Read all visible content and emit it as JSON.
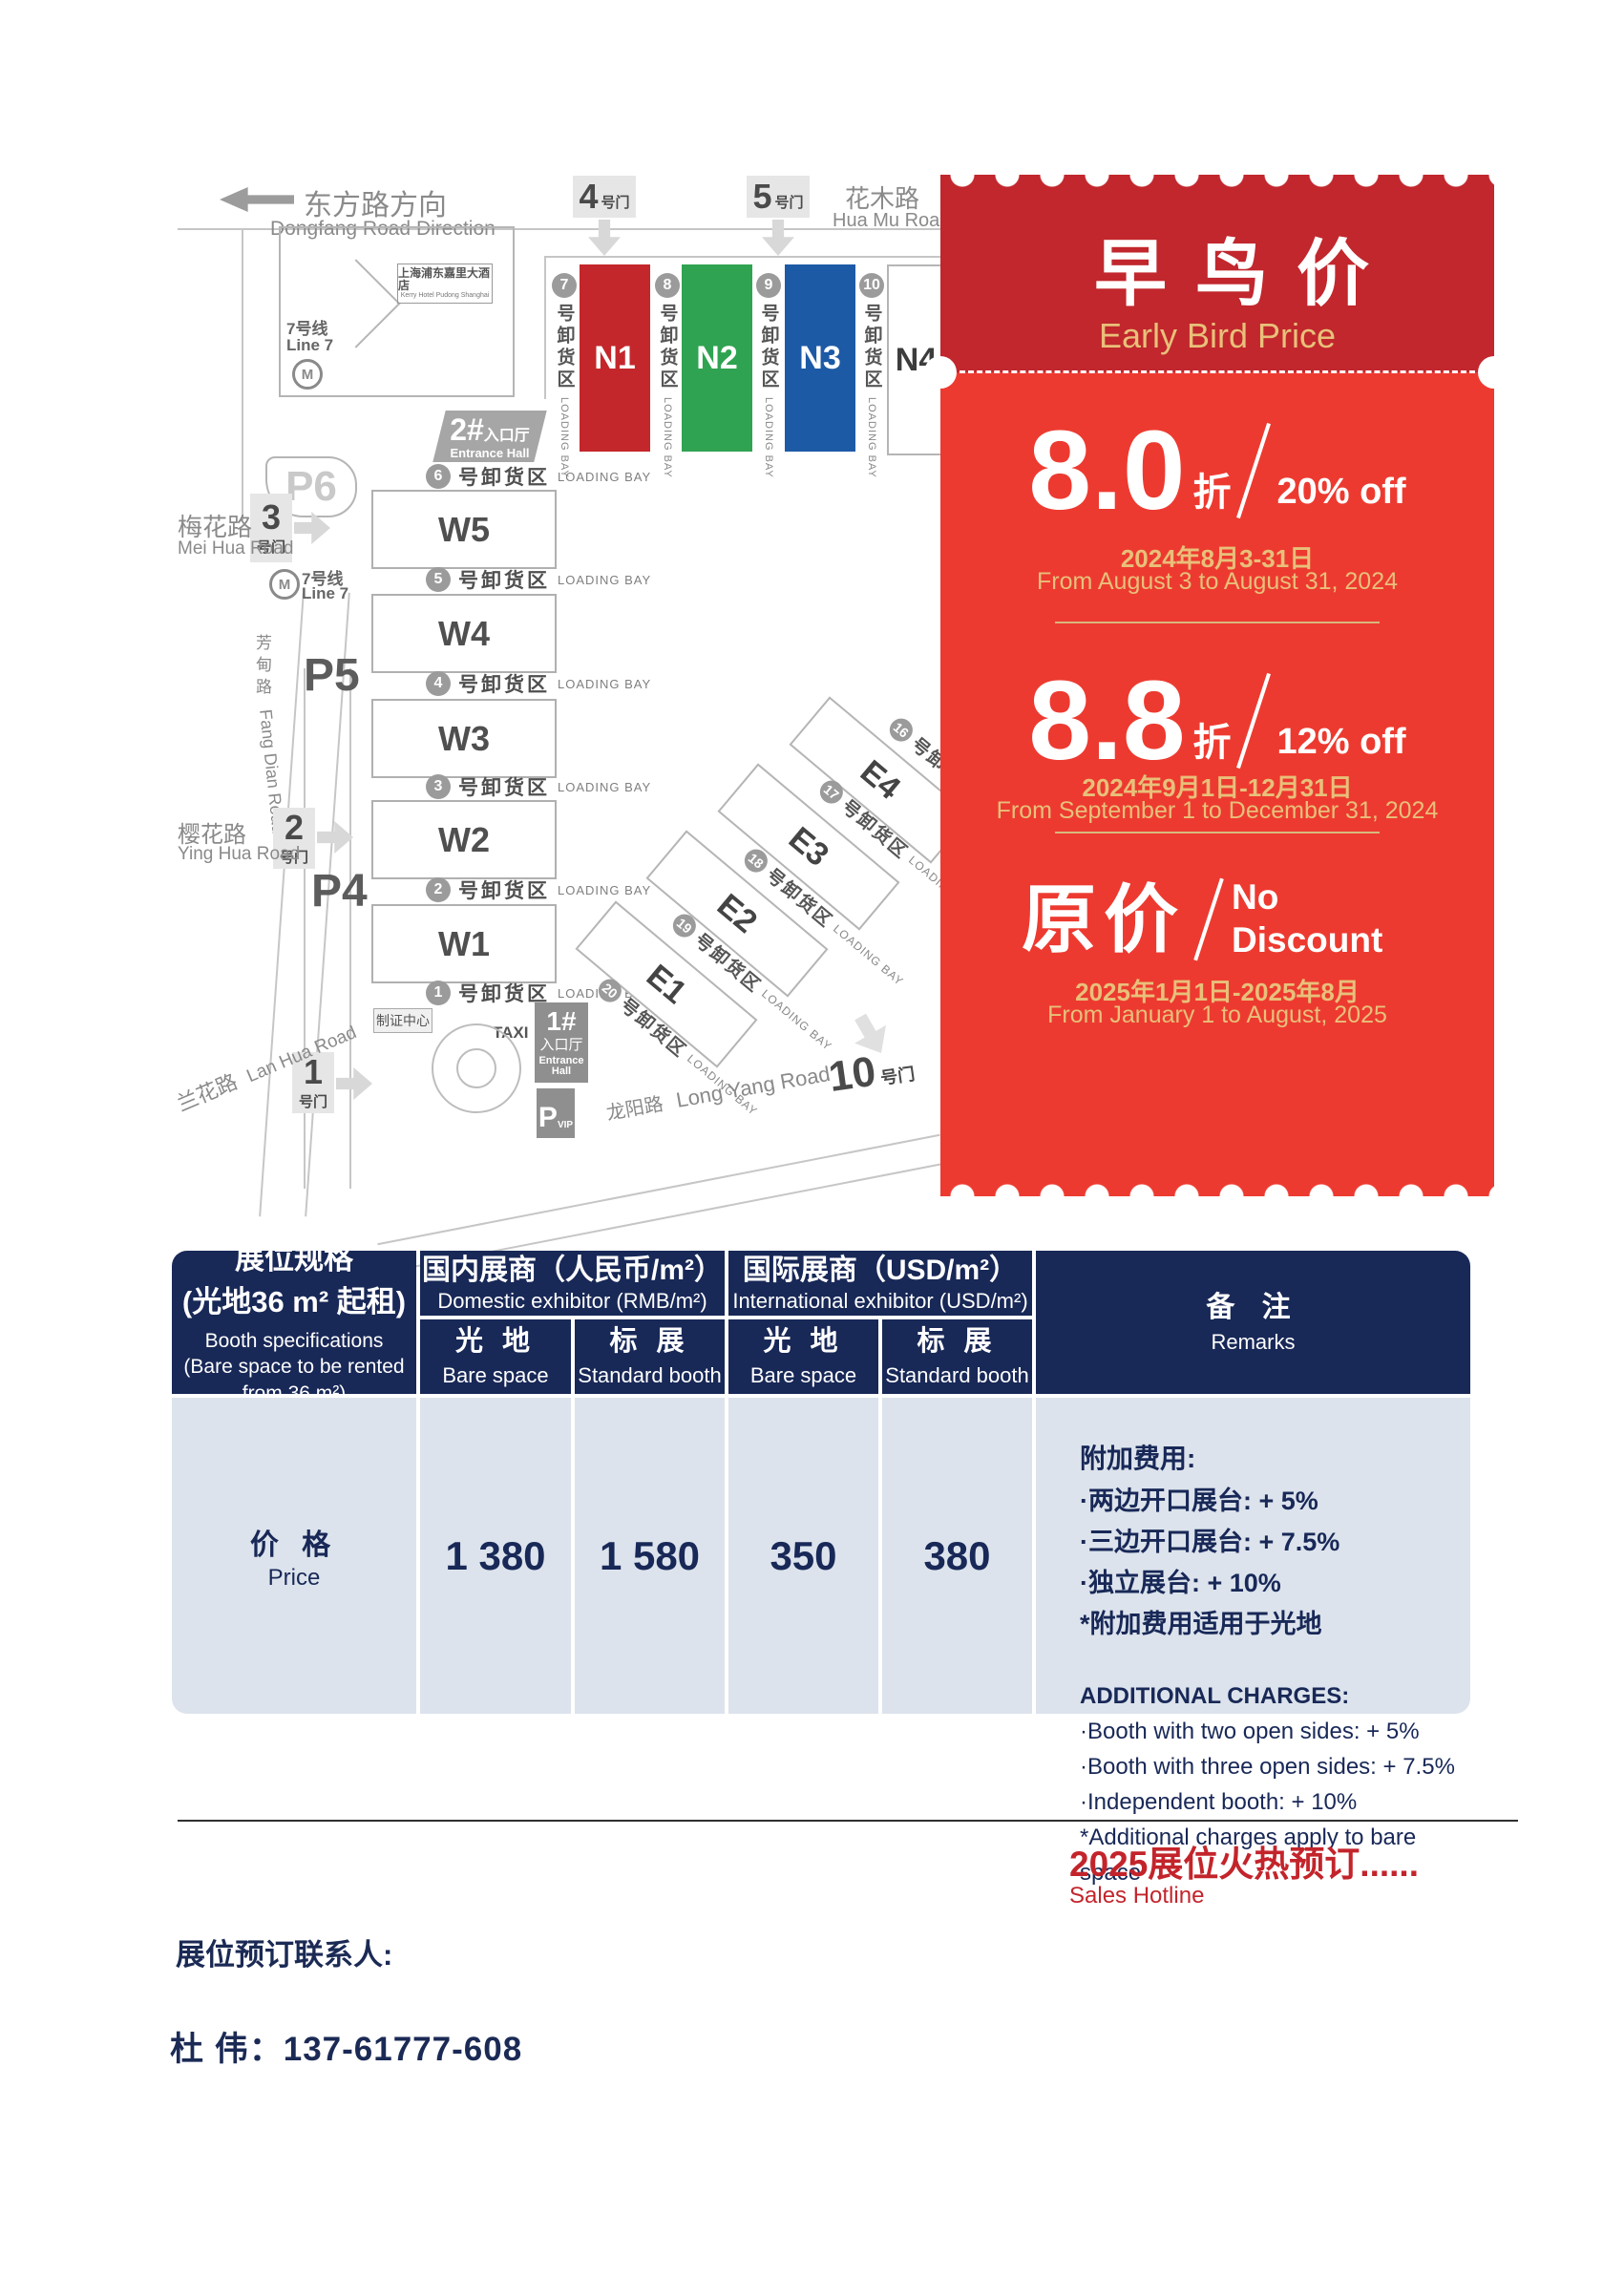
{
  "colors": {
    "hall_n1": "#c4272b",
    "hall_n2": "#2fa351",
    "hall_n3": "#1d5aa6",
    "ticket_top": "#c1272d",
    "ticket_body": "#ed3a30",
    "gold": "#e8c07a",
    "table_navy": "#182857",
    "table_light": "#dce3ec",
    "accent_red": "#c3242b"
  },
  "map": {
    "direction_zh": "东方路方向",
    "direction_en": "Dongfang Road Direction",
    "hotel_zh": "上海浦东嘉里大酒店",
    "hotel_en": "Kerry Hotel Pudong Shanghai",
    "line7_zh": "7号线",
    "line7_en": "Line 7",
    "metro_m": "M",
    "huamu_zh": "花木路",
    "huamu_en": "Hua Mu Road",
    "meihua_zh": "梅花路",
    "meihua_en": "Mei Hua Road",
    "yinghua_zh": "樱花路",
    "yinghua_en": "Ying Hua Road",
    "lanhua_zh": "兰花路",
    "lanhua_en": "Lan Hua Road",
    "fangdian_zh": "芳甸路",
    "fangdian_en": "Fang Dian Road",
    "longyang_zh": "龙阳路",
    "longyang_en": "Long Yang Road",
    "gate_suffix": "号门",
    "gates": {
      "g1": "1",
      "g2": "2",
      "g3": "3",
      "g4": "4",
      "g5": "5",
      "g10": "10"
    },
    "parking": {
      "p4": "P4",
      "p5": "P5",
      "p6": "P6",
      "pvip": "P",
      "pvip_sub": "VIP"
    },
    "entrance1_num": "1#",
    "entrance2_num": "2#",
    "entrance_zh": "入口厅",
    "entrance_en": "Entrance Hall",
    "badge_center": "制证中心",
    "taxi": "TAXI",
    "loading_zh": "号卸货区",
    "loading_en": "LOADING BAY",
    "halls_n": [
      "N1",
      "N2",
      "N3",
      "N4"
    ],
    "halls_w": [
      "W5",
      "W4",
      "W3",
      "W2",
      "W1"
    ],
    "halls_e": [
      "E4",
      "E3",
      "E2",
      "E1"
    ],
    "bays_n": [
      "7",
      "8",
      "9",
      "10"
    ],
    "bays_w": [
      "6",
      "5",
      "4",
      "3",
      "2",
      "1"
    ],
    "bays_e": [
      "16",
      "17",
      "18",
      "19",
      "20"
    ]
  },
  "ticket": {
    "title_zh": "早鸟价",
    "title_en": "Early Bird Price",
    "tier1_num": "8.0",
    "tier1_unit": "折",
    "tier1_off": "20% off",
    "tier1_date_zh": "2024年8月3-31日",
    "tier1_date_en": "From August 3 to August 31, 2024",
    "tier2_num": "8.8",
    "tier2_unit": "折",
    "tier2_off": "12% off",
    "tier2_date_zh": "2024年9月1日-12月31日",
    "tier2_date_en": "From September 1 to December 31, 2024",
    "tier3_num": "原价",
    "tier3_off": "No Discount",
    "tier3_date_zh": "2025年1月1日-2025年8月",
    "tier3_date_en": "From January 1 to August, 2025"
  },
  "table": {
    "spec_zh1": "展位规格",
    "spec_zh2": "(光地36 m² 起租)",
    "spec_en": "Booth specifications\n(Bare space to be rented\nfrom 36 m²)",
    "domestic_zh": "国内展商（人民币/m²）",
    "domestic_en": "Domestic exhibitor (RMB/m²)",
    "international_zh": "国际展商（USD/m²）",
    "international_en": "International exhibitor (USD/m²)",
    "bare_zh": "光 地",
    "bare_en": "Bare space",
    "standard_zh": "标 展",
    "standard_en": "Standard booth",
    "remarks_zh": "备 注",
    "remarks_en": "Remarks",
    "price_zh": "价 格",
    "price_en": "Price",
    "values": [
      "1 380",
      "1 580",
      "350",
      "380"
    ],
    "notes_zh": [
      "附加费用:",
      "·两边开口展台: + 5%",
      "·三边开口展台: + 7.5%",
      "·独立展台: + 10%",
      "*附加费用适用于光地"
    ],
    "notes_en": [
      "ADDITIONAL CHARGES:",
      "·Booth with two open sides: + 5%",
      "·Booth with three open sides: + 7.5%",
      "·Independent booth: + 10%",
      "*Additional charges apply to bare space"
    ]
  },
  "footer": {
    "sales_zh": "2025展位火热预订......",
    "sales_en": "Sales Hotline",
    "contact_label": "展位预订联系人:",
    "contact_phone": "杜  伟：137-61777-608"
  }
}
